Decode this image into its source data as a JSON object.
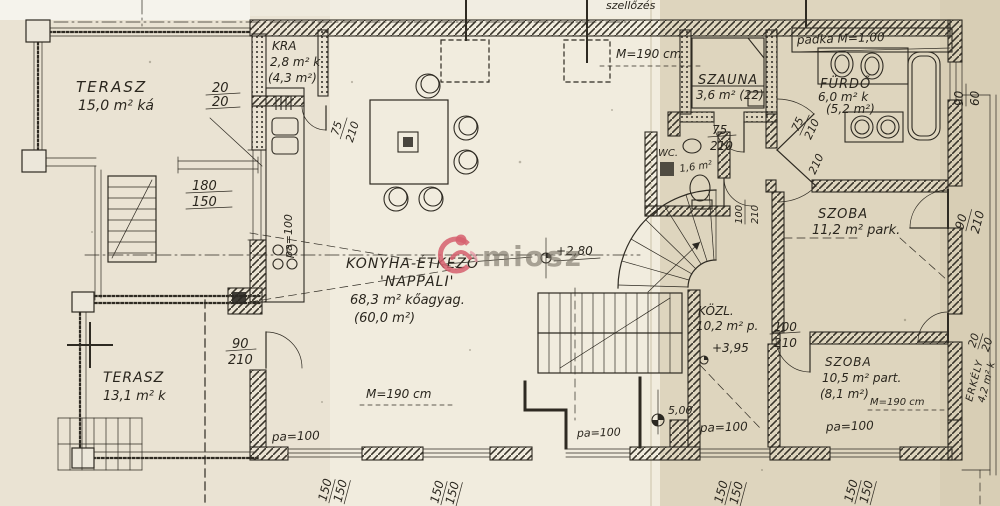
{
  "watermark": {
    "text": "miosz",
    "logo_color": "#d6606f"
  },
  "rooms": {
    "terasz_felso": {
      "name": "TERASZ",
      "area": "15,0 m² ká"
    },
    "kamra": {
      "name": "KRA",
      "area": "2,8 m² k",
      "area_net": "(4,3 m²)"
    },
    "nappali": {
      "name_line1": "KONYHA-ÉTKEZŐ",
      "name_line2": "'NAPPALI'",
      "area": "68,3 m² kőagyag.",
      "area_net": "(60,0 m²)"
    },
    "szauna": {
      "name": "SZAUNA",
      "area": "3,6 m² (22)"
    },
    "furdo": {
      "name": "FÜRDŐ",
      "area": "6,0 m² k",
      "area_net": "(5,2 m²)"
    },
    "wc": {
      "name": "WC.",
      "area": "1,6 m²"
    },
    "szoba_felso": {
      "name": "SZOBA",
      "area": "11,2 m² park."
    },
    "kozlekedo": {
      "name": "KÖZL.",
      "area": "10,2 m² p."
    },
    "szoba_also": {
      "name": "SZOBA",
      "area": "10,5 m² part.",
      "area_net": "(8,1 m²)",
      "height": "M=190 cm"
    },
    "erkely": {
      "name": "ERKÉLY",
      "area": "4,2 m² k"
    },
    "terasz_also": {
      "name": "TERASZ",
      "area": "13,1 m² k"
    }
  },
  "annotations": {
    "szellozes": "szellőzés",
    "padka": "padka M=1,00",
    "ceiling_height_top": "M=190 cm",
    "ceiling_height_bottom": "M=190 cm",
    "level_plus280": "+2,80",
    "level_plus395": "+3,95",
    "level_500": "5,00"
  },
  "dimensions": {
    "d20a": "20",
    "d20b": "20",
    "d180": "180",
    "d150": "150",
    "d90_terasz": "90",
    "d210_terasz": "210",
    "d75_kamra": "75",
    "d210_kamra": "210",
    "pa100_konyha": "pa=100",
    "d75_szauna": "75",
    "d210_szauna": "210",
    "d75_furdo": "75",
    "d210_furdo": "210",
    "d210_furdo2": "210",
    "d100_wc": "100",
    "d210_wc": "210",
    "d90_furdo_ablak": "90",
    "d60_furdo_ablak": "60",
    "d90_erkely_ajto": "90",
    "d210_erkely_ajto": "210",
    "d20c": "20",
    "d20d": "20",
    "d100_szoba": "100",
    "d210_szoba": "210",
    "pa100_terasz": "pa=100",
    "pa100_bejarat": "pa=100",
    "pa100_del1": "pa=100",
    "pa100_del2": "pa=100",
    "ablak150_1a": "150",
    "ablak150_1b": "150",
    "ablak150_2a": "150",
    "ablak150_2b": "150",
    "ablak150_3a": "150",
    "ablak150_3b": "150",
    "ablak150_4a": "150",
    "ablak150_4b": "150"
  }
}
